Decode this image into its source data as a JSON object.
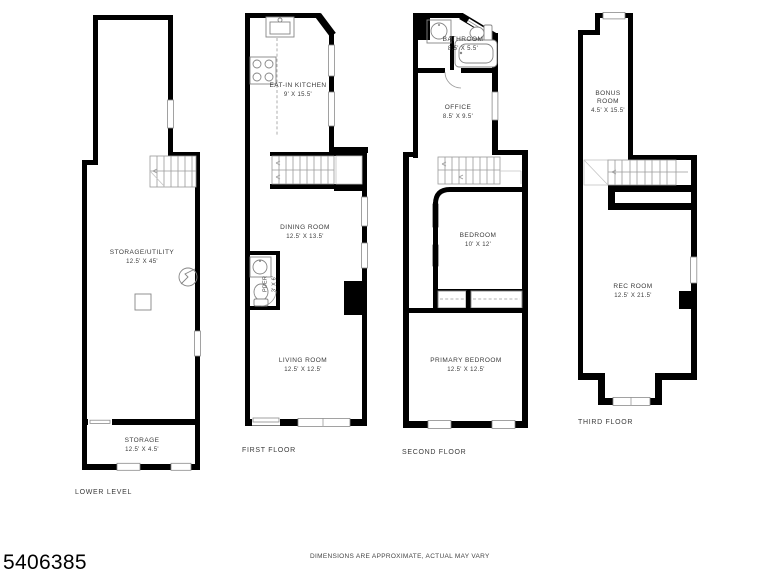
{
  "page": {
    "listing_id": "5406385",
    "disclaimer": "DIMENSIONS ARE APPROXIMATE, ACTUAL MAY VARY"
  },
  "colors": {
    "wall": "#000000",
    "fixture": "#858585",
    "stair": "#9a9a9a",
    "text": "#3a3a3a"
  },
  "floors": [
    {
      "label": "LOWER LEVEL",
      "rooms": [
        {
          "name": "STORAGE/UTILITY",
          "dims": "12.5' X 45'"
        },
        {
          "name": "STORAGE",
          "dims": "12.5' X 4.5'"
        }
      ]
    },
    {
      "label": "FIRST FLOOR",
      "rooms": [
        {
          "name": "EAT-IN KITCHEN",
          "dims": "9' X 15.5'"
        },
        {
          "name": "DINING ROOM",
          "dims": "12.5' X 13.5'"
        },
        {
          "name": "PDER",
          "dims": "3' X 6'"
        },
        {
          "name": "LIVING ROOM",
          "dims": "12.5' X 12.5'"
        }
      ]
    },
    {
      "label": "SECOND FLOOR",
      "rooms": [
        {
          "name": "BATHROOM",
          "dims": "8.5' X 5.5'"
        },
        {
          "name": "OFFICE",
          "dims": "8.5' X 9.5'"
        },
        {
          "name": "BEDROOM",
          "dims": "10' X 12'"
        },
        {
          "name": "PRIMARY BEDROOM",
          "dims": "12.5' X 12.5'"
        }
      ]
    },
    {
      "label": "THIRD FLOOR",
      "rooms": [
        {
          "name": "BONUS ROOM",
          "dims": "4.5' X 15.5'"
        },
        {
          "name": "REC ROOM",
          "dims": "12.5' X 21.5'"
        }
      ]
    }
  ]
}
